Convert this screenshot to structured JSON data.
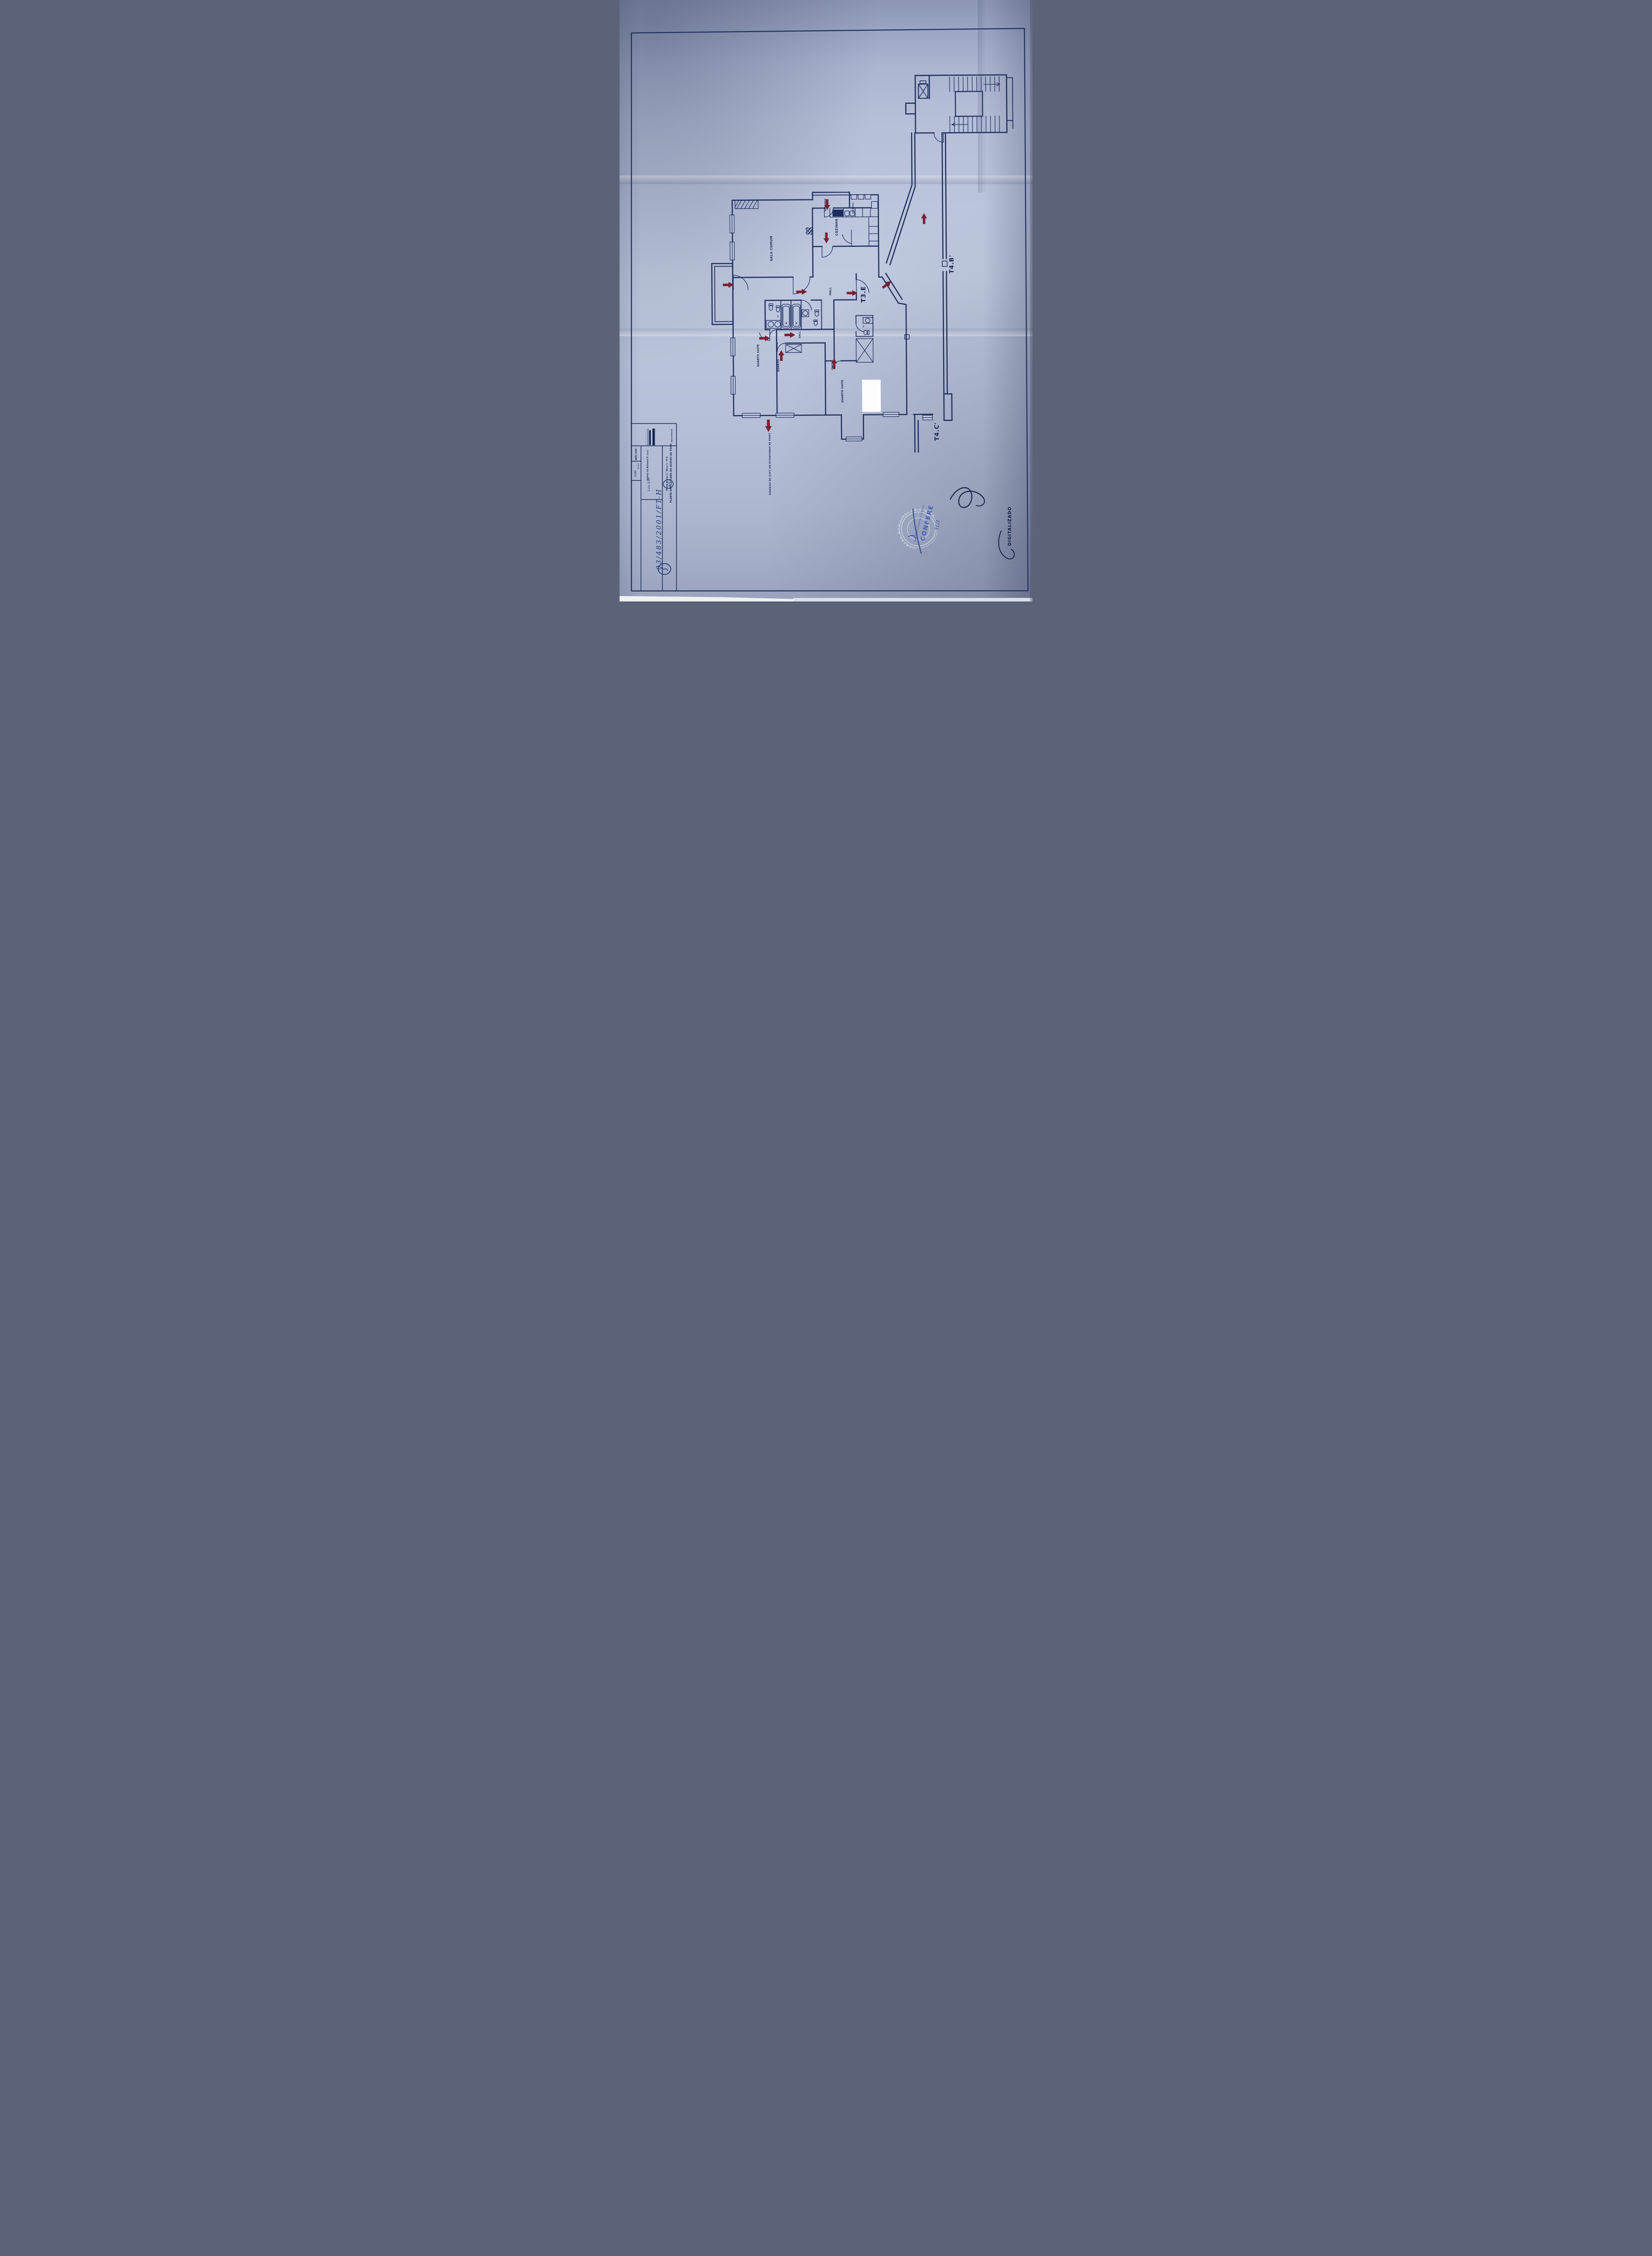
{
  "colors": {
    "ink": "#1e2d5e",
    "red_arrow": "#7b2030",
    "paper": "#b7c1dc",
    "stamp_blue": "#3c55b5",
    "hand_ink": "#2b3f8c"
  },
  "plan": {
    "unit_label": "T3.E",
    "neighbor_unit_top": "T4.B'",
    "neighbor_unit_bottom": "T4.C'",
    "rooms": {
      "sala": "SALA COMUM",
      "cozinha": "COZINHA",
      "varanda": "VARANDA",
      "estendal": "ESTENDAL",
      "hall": "HALL",
      "hall2": "HALL",
      "quarto_suite": "QUARTO SUITE",
      "quarto": "QUARTO",
      "quarto_suite2": "QUARTO SUITE",
      "is1": "I.S.",
      "is2": "I.S."
    },
    "emergency_note": "SAÍDA DE EMERGÊNCIA EM CASO DE INCÊNDIO"
  },
  "title_block": {
    "requerente_label": "REQUERENTE",
    "title": "PLANTA SIMPLIFICADA DO ACESSO AO FOGO",
    "subtitle": "Planta do piso 2 - Bloco 1 - T3 E",
    "local_label": "LOCAL",
    "local_value": "Quinta da Beloura II",
    "local_handwritten": "Lote EA6",
    "date": "ABRIL 2008",
    "scale_label": "ESCALA",
    "scale_value": "1:100",
    "handwritten_ref": "03/483/2001/FT-H",
    "handwritten_circled": "21"
  },
  "stamp": {
    "seal_text": "CÂMARA MUNICIPAL DE SINTRA",
    "confere": "CONFERE",
    "conforme": "Está conforme o original",
    "handwritten_date": "31/3"
  },
  "footer": {
    "digitalizado": "DIGITALIZADO"
  }
}
